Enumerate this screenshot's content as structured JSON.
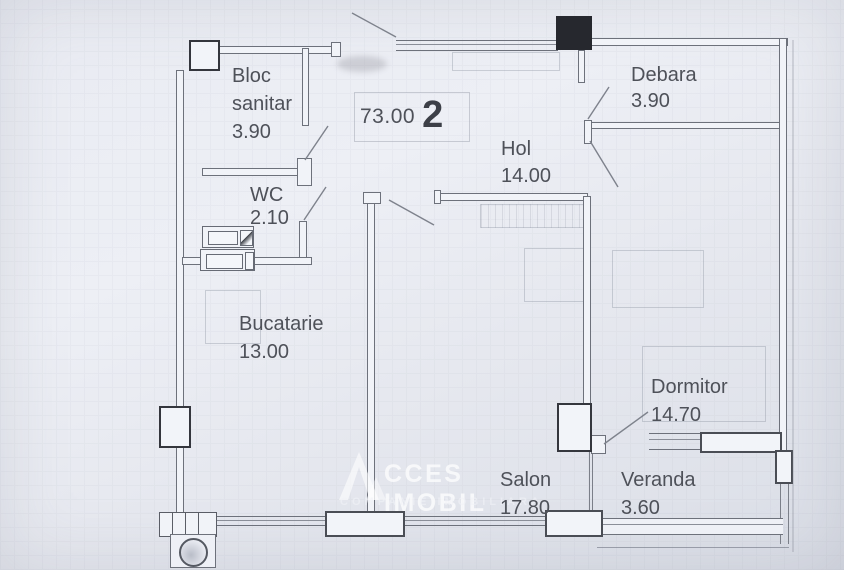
{
  "floorplan": {
    "total": {
      "area": "73.00",
      "room_count": "2"
    },
    "rooms": {
      "bloc_sanitar": {
        "name_line1": "Bloc",
        "name_line2": "sanitar",
        "area": "3.90"
      },
      "wc": {
        "name": "WC",
        "area": "2.10"
      },
      "hol": {
        "name": "Hol",
        "area": "14.00"
      },
      "debara": {
        "name": "Debara",
        "area": "3.90"
      },
      "bucatarie": {
        "name": "Bucatarie",
        "area": "13.00"
      },
      "dormitor": {
        "name": "Dormitor",
        "area": "14.70"
      },
      "salon": {
        "name": "Salon",
        "area": "17.80"
      },
      "veranda": {
        "name": "Veranda",
        "area": "3.60"
      }
    },
    "watermark": {
      "logo_letter": "A",
      "brand": "CCES IMOBIL",
      "tagline": "COMPANIE IMOBILIARA"
    },
    "colors": {
      "paper": "#e8eaf1",
      "line": "#6d717b",
      "text": "#4e5159",
      "pillar_dark": "#26282e"
    }
  }
}
